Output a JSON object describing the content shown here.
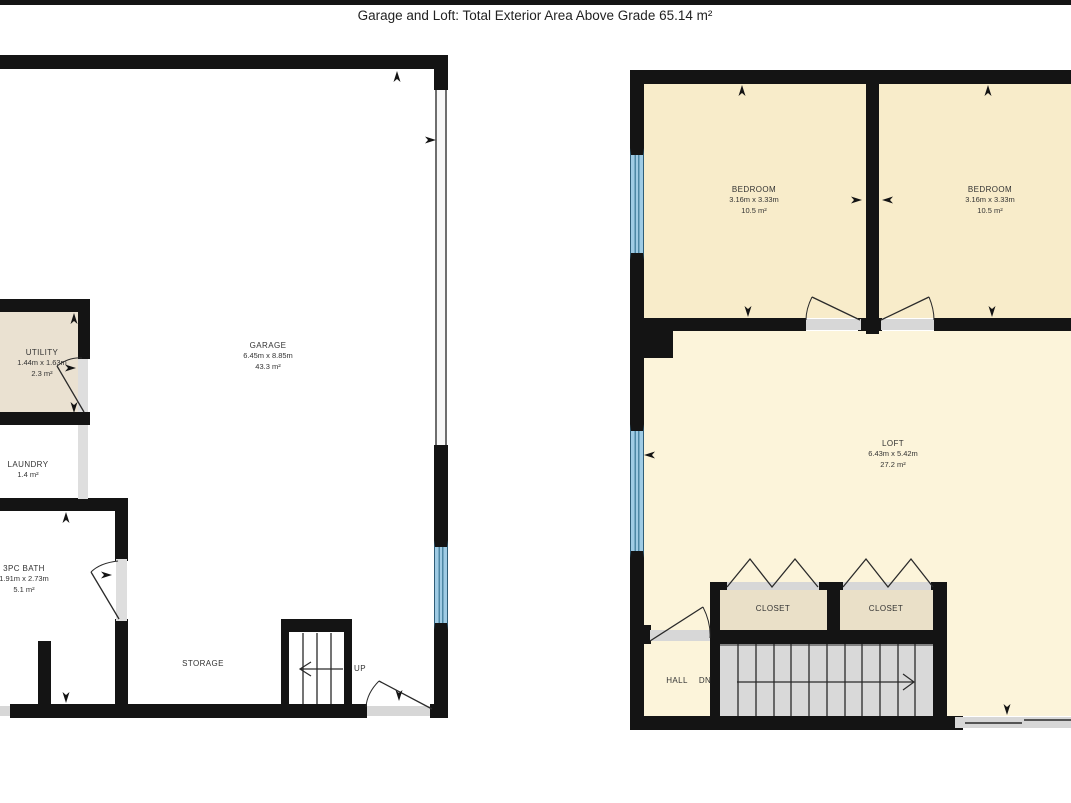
{
  "title": "Garage and Loft: Total Exterior Area Above Grade 65.14 m²",
  "rooms": {
    "utility": {
      "name": "UTILITY",
      "dims": "1.44m x 1.63m",
      "area": "2.3 m²"
    },
    "laundry": {
      "name": "LAUNDRY",
      "area": "1.4 m²"
    },
    "bath": {
      "name": "3PC BATH",
      "dims": "1.91m x 2.73m",
      "area": "5.1 m²"
    },
    "garage": {
      "name": "GARAGE",
      "dims": "6.45m x 8.85m",
      "area": "43.3 m²"
    },
    "storage": {
      "name": "STORAGE"
    },
    "stairs_up": {
      "name": "UP"
    },
    "bedroom_left": {
      "name": "BEDROOM",
      "dims": "3.16m x 3.33m",
      "area": "10.5 m²"
    },
    "bedroom_right": {
      "name": "BEDROOM",
      "dims": "3.16m x 3.33m",
      "area": "10.5 m²"
    },
    "loft": {
      "name": "LOFT",
      "dims": "6.43m x 5.42m",
      "area": "27.2 m²"
    },
    "closet_left": {
      "name": "CLOSET"
    },
    "closet_right": {
      "name": "CLOSET"
    },
    "hall": {
      "name": "HALL"
    },
    "stairs_down": {
      "name": "DN"
    }
  },
  "colors": {
    "wall": "#141414",
    "bedroom_floor": "#f8ecca",
    "loft_floor": "#fcf4da",
    "closet_floor": "#eae0c8",
    "utility_floor": "#eae1d1",
    "stairs_gray": "#d9d9d9",
    "window_blue": "#9fcbe4",
    "door_sill": "#d7d7d7"
  }
}
